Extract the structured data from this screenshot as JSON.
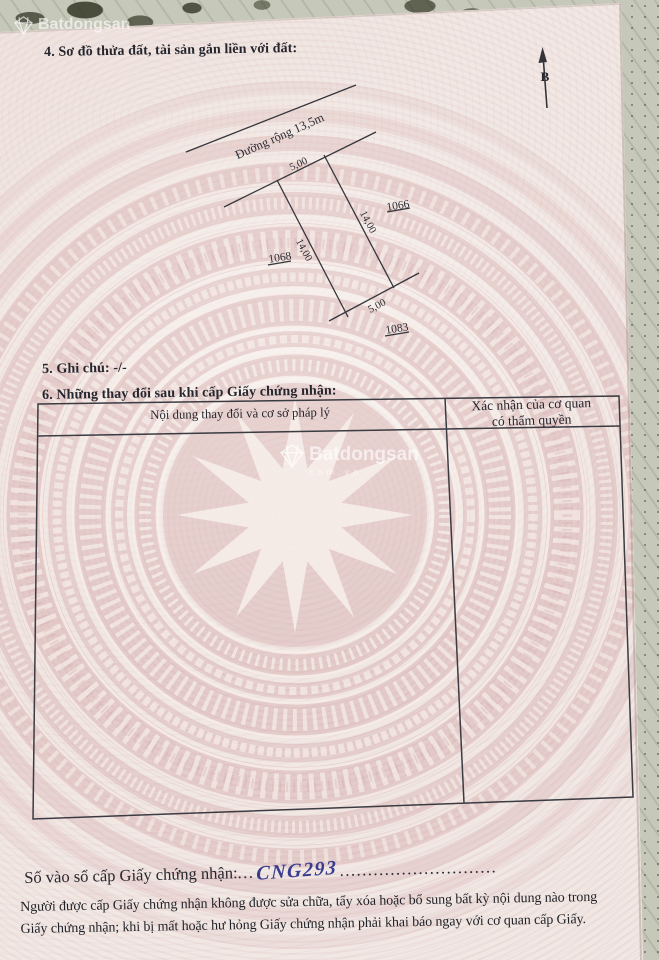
{
  "page": {
    "section4_title": "4. Sơ đồ thửa đất, tài sản gắn liền với đất:",
    "section5_title": "5. Ghi chú: -/-",
    "section6_title": "6. Những thay đổi sau khi cấp Giấy chứng nhận:"
  },
  "diagram": {
    "road_label": "Đường rộng 13,5m",
    "north_label": "B",
    "dim_top": "5,00",
    "dim_right": "14,00",
    "dim_left": "14,00",
    "dim_bottom": "5,00",
    "plot_right": "1066",
    "plot_left": "1068",
    "plot_bottom": "1083"
  },
  "table": {
    "col1_header": "Nội dung thay đổi và cơ sở pháp lý",
    "col2_header_line1": "Xác nhận của cơ quan",
    "col2_header_line2": "có thẩm quyền"
  },
  "registry": {
    "label": "Số vào sổ cấp Giấy chứng nhận:",
    "leader_dots": "...",
    "value": "CNG293",
    "trailing_dots": "............................"
  },
  "footer": {
    "line1": "Người được cấp Giấy chứng nhận không được sửa chữa, tẩy xóa hoặc bổ sung bất kỳ nội dung nào trong",
    "line2": "Giấy chứng nhận; khi bị mất hoặc hư hỏng Giấy chứng nhận phải khai báo ngay với cơ quan cấp Giấy."
  },
  "watermark": {
    "brand": "Batdongsan",
    "sub": "com.vn"
  },
  "colors": {
    "ink": "#26262e",
    "handwriting_blue": "#3a3d8f",
    "drum_pink": "#cb989c",
    "paper": "#f1e8e4"
  }
}
